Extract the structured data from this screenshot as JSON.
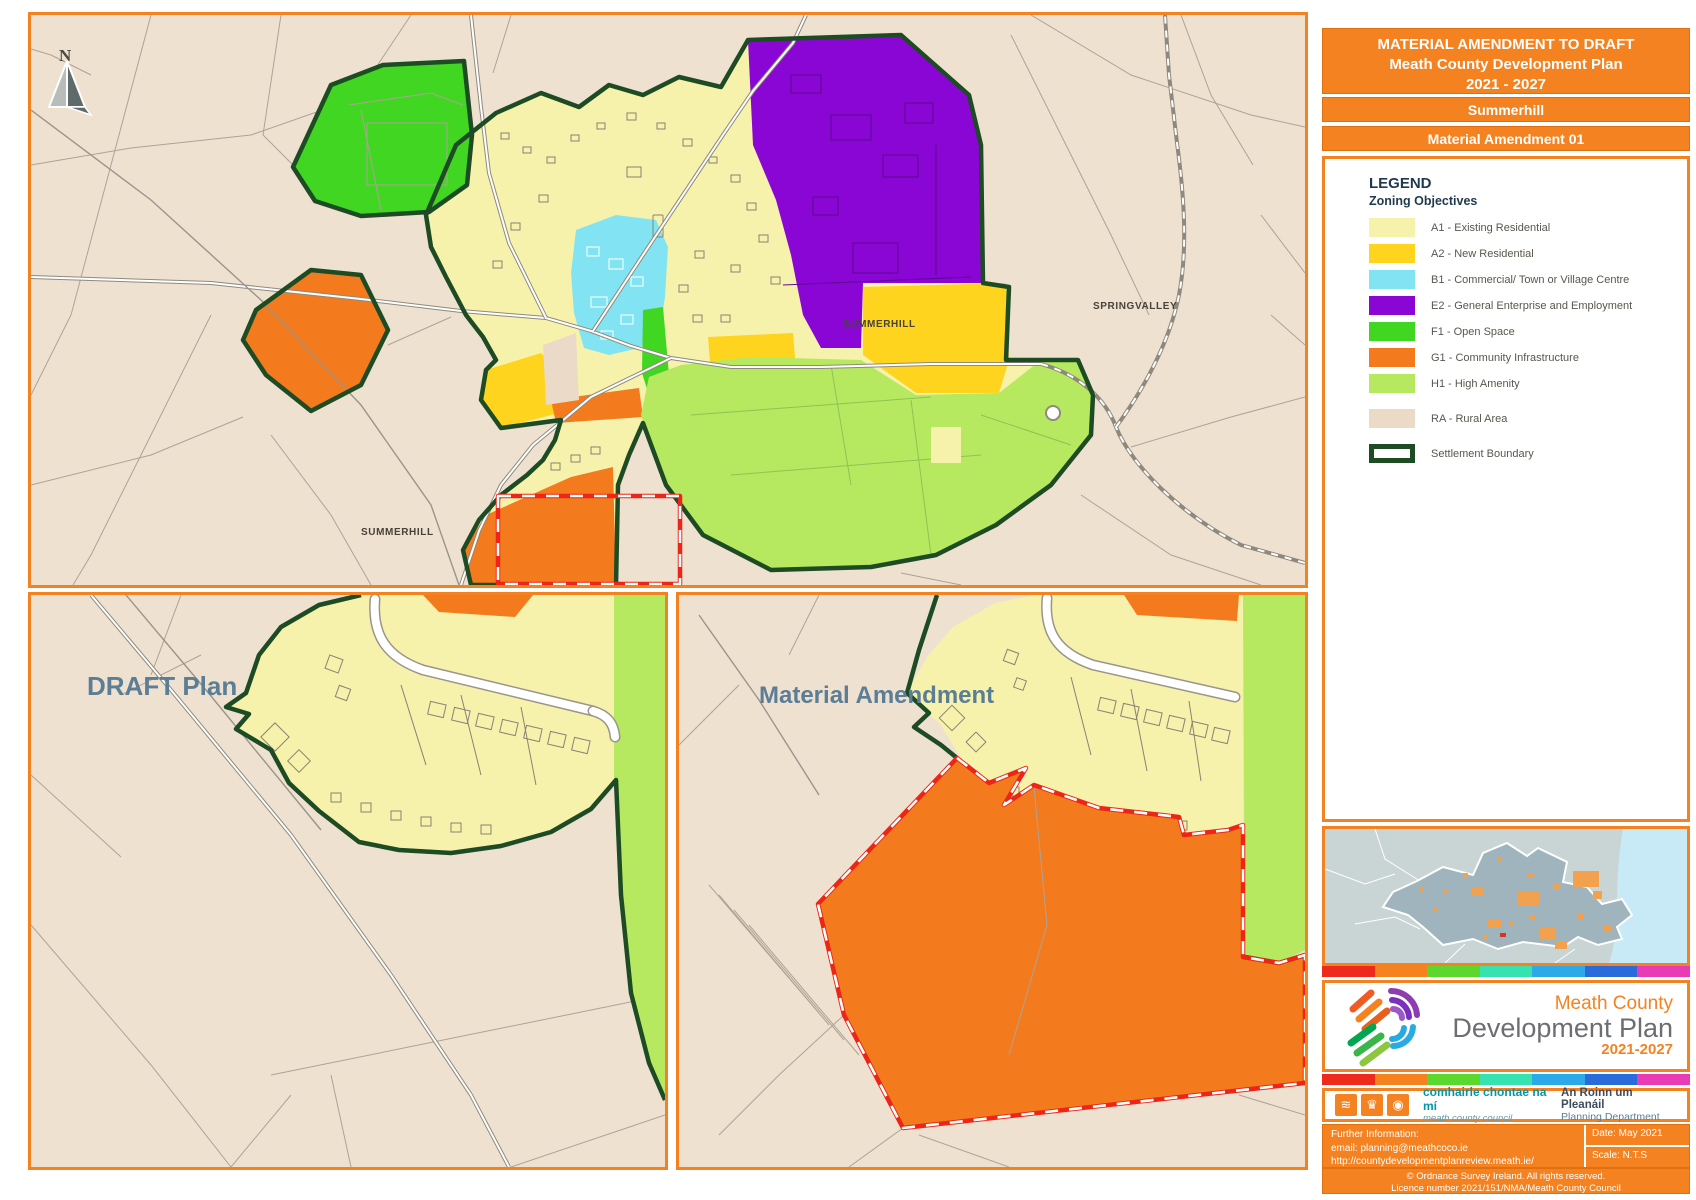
{
  "title_block": {
    "line1": "MATERIAL AMENDMENT TO DRAFT",
    "line2": "Meath County Development Plan",
    "line3": "2021 - 2027"
  },
  "settlement_banner": "Summerhill",
  "amendment_banner": "Material Amendment 01",
  "legend": {
    "heading": "LEGEND",
    "subheading": "Zoning Objectives",
    "items": [
      {
        "label": "A1 - Existing Residential",
        "color": "#F6F2AC"
      },
      {
        "label": "A2 - New Residential",
        "color": "#FFD41E"
      },
      {
        "label": "B1 - Commercial/ Town or Village Centre",
        "color": "#82E4F2"
      },
      {
        "label": "E2 - General Enterprise and Employment",
        "color": "#8A06D4"
      },
      {
        "label": "F1 - Open Space",
        "color": "#41D621"
      },
      {
        "label": "G1 - Community Infrastructure",
        "color": "#F47B1D"
      },
      {
        "label": "H1 - High Amenity",
        "color": "#B6E95F"
      },
      {
        "label": "RA - Rural Area",
        "color": "#EBDAC8"
      }
    ],
    "boundary_label": "Settlement Boundary",
    "boundary_color": "#1D4B24"
  },
  "main_map": {
    "north_label": "N",
    "label_town": "SUMMERHILL",
    "label_springvalley": "SPRINGVALLEY",
    "label_rural": "SUMMERHILL"
  },
  "panels": {
    "draft_label": "DRAFT Plan",
    "amendment_label": "Material Amendment"
  },
  "branding": {
    "logo_line1": "Meath County",
    "logo_line2": "Development Plan",
    "logo_years": "2021-2027",
    "council_irish": "comhairle chontae na mí",
    "council_english": "meath county council",
    "dept_irish": "An Roinn um Pleanáil",
    "dept_english": "Planning Department"
  },
  "footer": {
    "further_info": "Further Information:",
    "email": "email: planning@meathcoco.ie",
    "url": "http://countydevelopmentplanreview.meath.ie/",
    "date": "Date: May 2021",
    "scale": "Scale: N.T.S",
    "copyright1": "© Ordnance Survey Ireland. All rights reserved.",
    "copyright2": "Licence number 2021/151/NMA/Meath County Council"
  },
  "stripe_colors": [
    "#EE2A1C",
    "#F5821F",
    "#5BD72E",
    "#35E2B0",
    "#2BA9E8",
    "#2A6BDC",
    "#E83BB5"
  ],
  "colors": {
    "frame_orange": "#F58220",
    "settlement_boundary_green": "#1D4B24",
    "amendment_red": "#EC2517",
    "rural_base": "#EFE1D0",
    "panel_title_blue": "#5B7E96",
    "locator_land": "#C9D5D4",
    "locator_sea": "#C8E9F6",
    "locator_county": "#9FB4BD",
    "locator_town_orange": "#F2A24E"
  }
}
